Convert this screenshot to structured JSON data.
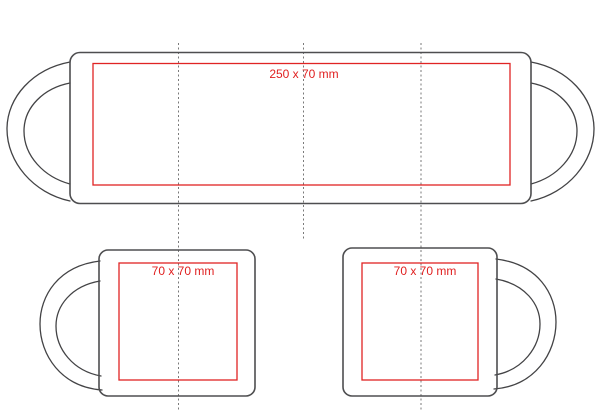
{
  "diagram": {
    "type": "mug-print-template",
    "background_color": "#ffffff",
    "colors": {
      "mug_outline": "#4e4e50",
      "print_area_border": "#e02424",
      "label_text": "#e01f1f",
      "guide_line": "#7a7a7a"
    },
    "views": {
      "wrap": {
        "description": "full wrap view with handle silhouettes on both ends",
        "print_area_label": "250 x 70 mm"
      },
      "left_side": {
        "description": "side view, handle on left",
        "print_area_label": "70 x 70 mm"
      },
      "right_side": {
        "description": "side view, handle on right",
        "print_area_label": "70 x 70 mm"
      }
    },
    "guides": {
      "style": "dotted vertical center lines",
      "count": 3
    }
  }
}
